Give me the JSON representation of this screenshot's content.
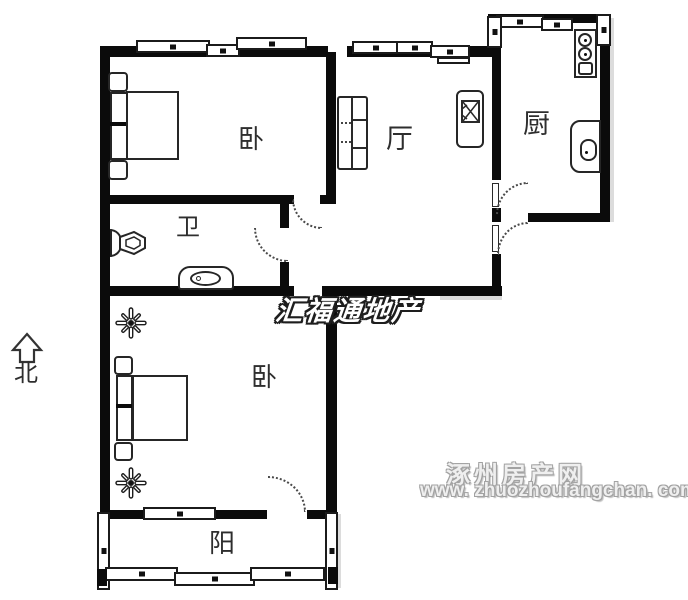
{
  "compass": {
    "label": "北"
  },
  "rooms": [
    {
      "id": "bedroom-1",
      "label": "卧"
    },
    {
      "id": "living-room",
      "label": "厅"
    },
    {
      "id": "kitchen",
      "label": "厨"
    },
    {
      "id": "bathroom",
      "label": "卫"
    },
    {
      "id": "bedroom-2",
      "label": "卧"
    },
    {
      "id": "balcony",
      "label": "阳"
    }
  ],
  "watermarks": {
    "center": "汇福通地产",
    "site_name": "涿州房产网",
    "site_url": "www. zhuozhoufangchan. com"
  },
  "colors": {
    "wall": "#0b0b0b",
    "line": "#262626",
    "background": "#ffffff",
    "center_watermark_fill": "#ffffff",
    "center_watermark_outline": "#1e1e1e",
    "site_watermark": "#efefef"
  },
  "icons": {
    "north-arrow": "hollow up arrow",
    "bed": "double bed top view",
    "sofa": "sofa top view",
    "tv": "tv on stand",
    "stove": "two-burner stove",
    "kitchen-sink": "counter sink",
    "toilet": "toilet top view",
    "vanity": "bathroom basin",
    "plant": "decorative flower",
    "window": "double-line window with tick",
    "door-arc": "dotted door swing"
  }
}
